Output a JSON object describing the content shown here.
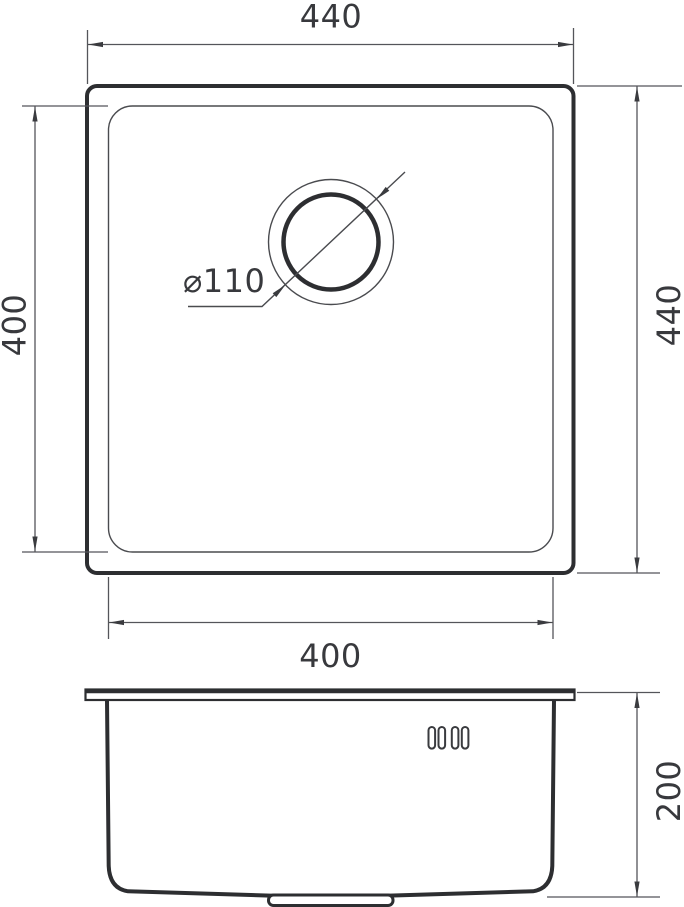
{
  "drawing": {
    "background_color": "#ffffff",
    "line_color": "#2d2e31",
    "thin_line_color": "#4a4b4f",
    "dimension_line_color": "#54555a",
    "text_color": "#38393d",
    "top_view": {
      "outer_width": "440",
      "outer_height": "440",
      "inner_width": "400",
      "inner_height": "400",
      "drain_diameter": "⌀110"
    },
    "side_view": {
      "depth": "200"
    }
  }
}
